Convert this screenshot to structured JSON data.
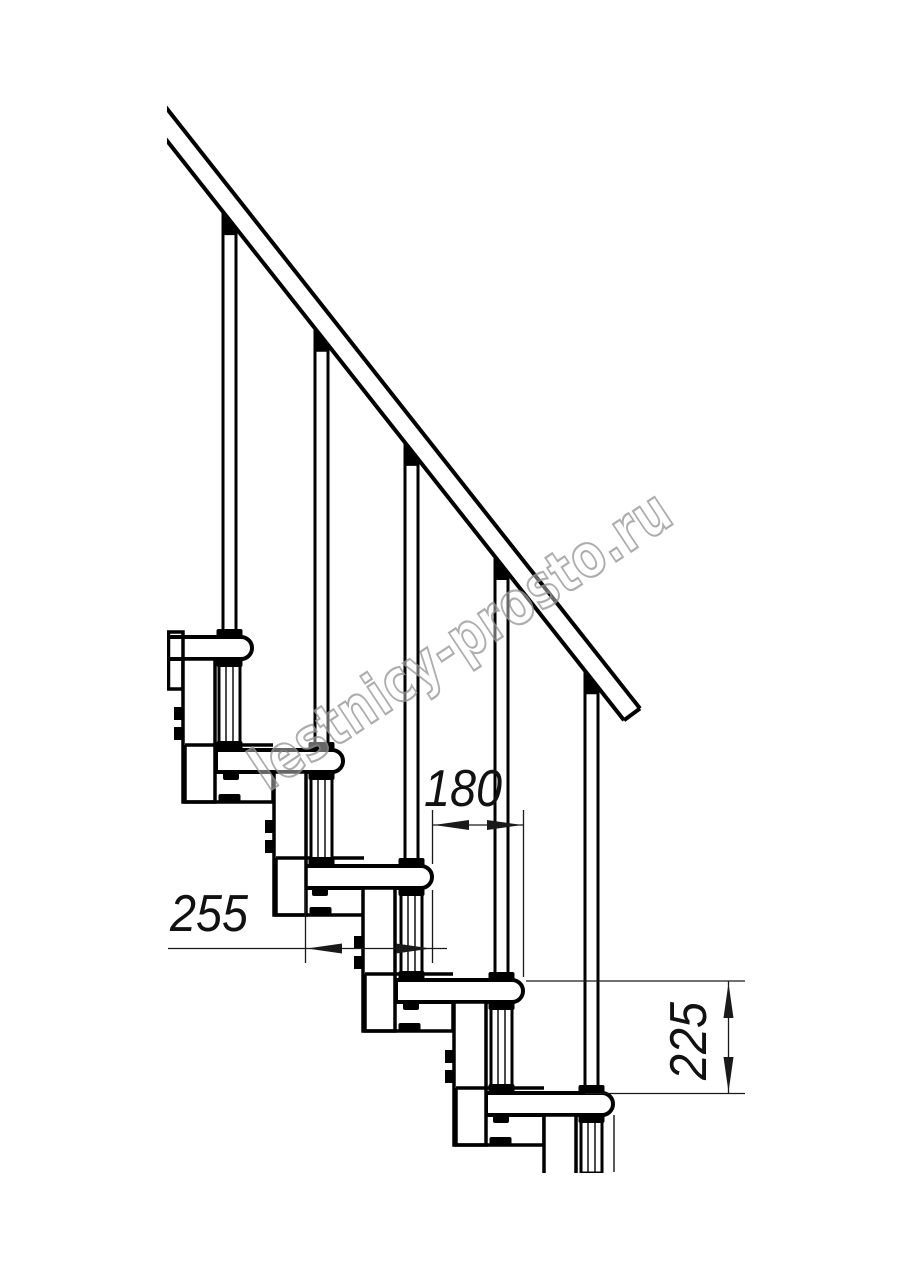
{
  "page": {
    "title": "Modular staircase side-view technical drawing",
    "background": "#ffffff",
    "line_color": "#000000",
    "thin_line_color": "#1a1a1a"
  },
  "watermark": {
    "text": "lestnicy-prosto.ru",
    "outline_color": "#999999",
    "fill_color": "rgba(255,255,255,0.5)"
  },
  "drawing": {
    "type": "staircase-elevation",
    "treads_visible": 5,
    "balusters_visible": 5,
    "handrail": "inclined, cut off at left edge",
    "modules": "bolted Z-brackets between treads, 2 bolts each"
  },
  "dimensions": {
    "run": {
      "label": "180",
      "meaning": "horizontal step offset"
    },
    "tread": {
      "label": "255",
      "meaning": "tread depth"
    },
    "rise": {
      "label": "225",
      "meaning": "step rise"
    }
  }
}
